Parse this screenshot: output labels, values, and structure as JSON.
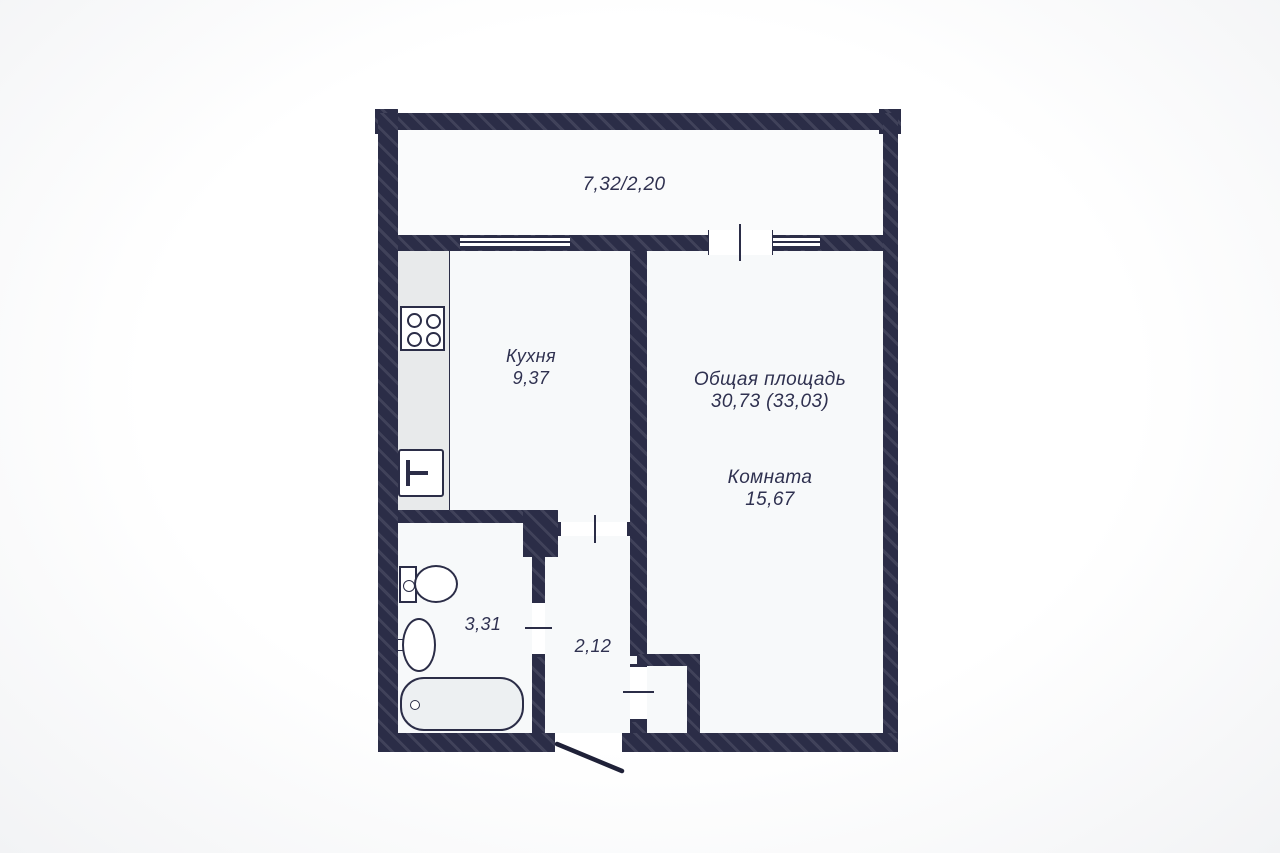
{
  "plan": {
    "balcony": {
      "dims": "7,32/2,20"
    },
    "kitchen": {
      "name": "Кухня",
      "area": "9,37"
    },
    "total": {
      "label": "Общая площадь",
      "value": "30,73 (33,03)"
    },
    "living_room": {
      "name": "Комната",
      "area": "15,67"
    },
    "bathroom": {
      "area": "3,31"
    },
    "hallway": {
      "area": "2,12"
    },
    "colors": {
      "wall": "#2b2d47",
      "wall_hatch_highlight": "rgba(255,255,255,0.10)",
      "apartment_floor": "#f7f9fa",
      "balcony_floor": "#fafbfc",
      "counter": "#e8eaeb",
      "bathtub_fill": "#edf0f2",
      "label_text": "#2f3150",
      "background": "#ffffff"
    }
  }
}
